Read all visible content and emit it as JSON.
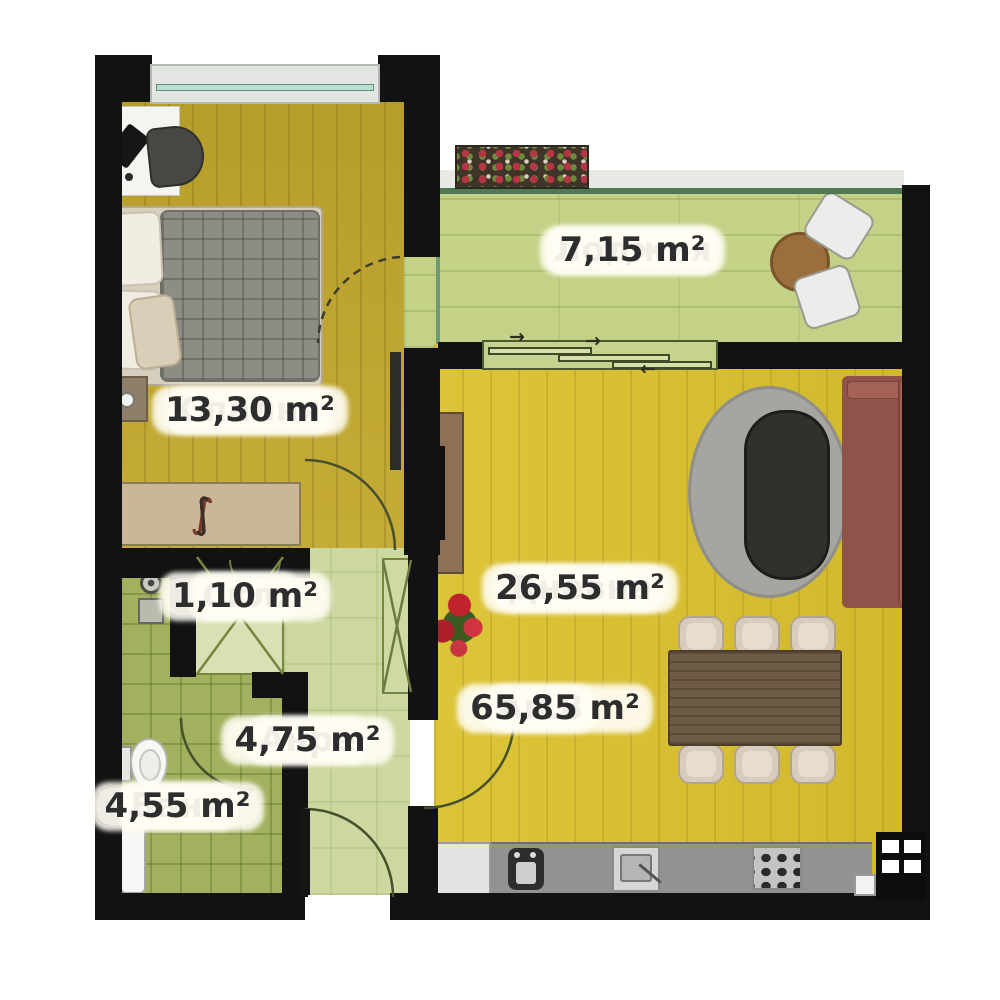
{
  "labels": {
    "loggia": {
      "name": "Лоджия",
      "area": "7,15 m²"
    },
    "bedroom": {
      "name": "Спалня",
      "area": "13,30 m²"
    },
    "storage": {
      "name": "Скл.",
      "area": "1,10 m²"
    },
    "hall": {
      "name": "Анре",
      "area": "4,75 m²"
    },
    "bath": {
      "name": "Баня",
      "area": "4,55 m²"
    },
    "living": {
      "name": "Дневна",
      "area": "26,55 m²"
    },
    "apartment": {
      "name": "Ап.8",
      "area": "65,85 m²"
    }
  },
  "icons": {
    "hanger": "∫",
    "arrow_right": "→",
    "arrow_left": "←"
  },
  "colors": {
    "wall": "#121212",
    "bedroom_floor": "#bfa52d",
    "living_floor": "#d9c02f",
    "loggia_floor": "#c3d287",
    "hall_floor": "#cdd8a0",
    "bath_floor": "#a2b15e",
    "storage_floor": "#d8e0b4",
    "sofa": "#9c5f55",
    "rug": "#a7a5a0",
    "dining_table": "#6e5c46",
    "counter": "#929292",
    "window_glass": "#bcded2",
    "label_text": "#2d2d2d",
    "label_bg": "#fffdf6"
  }
}
